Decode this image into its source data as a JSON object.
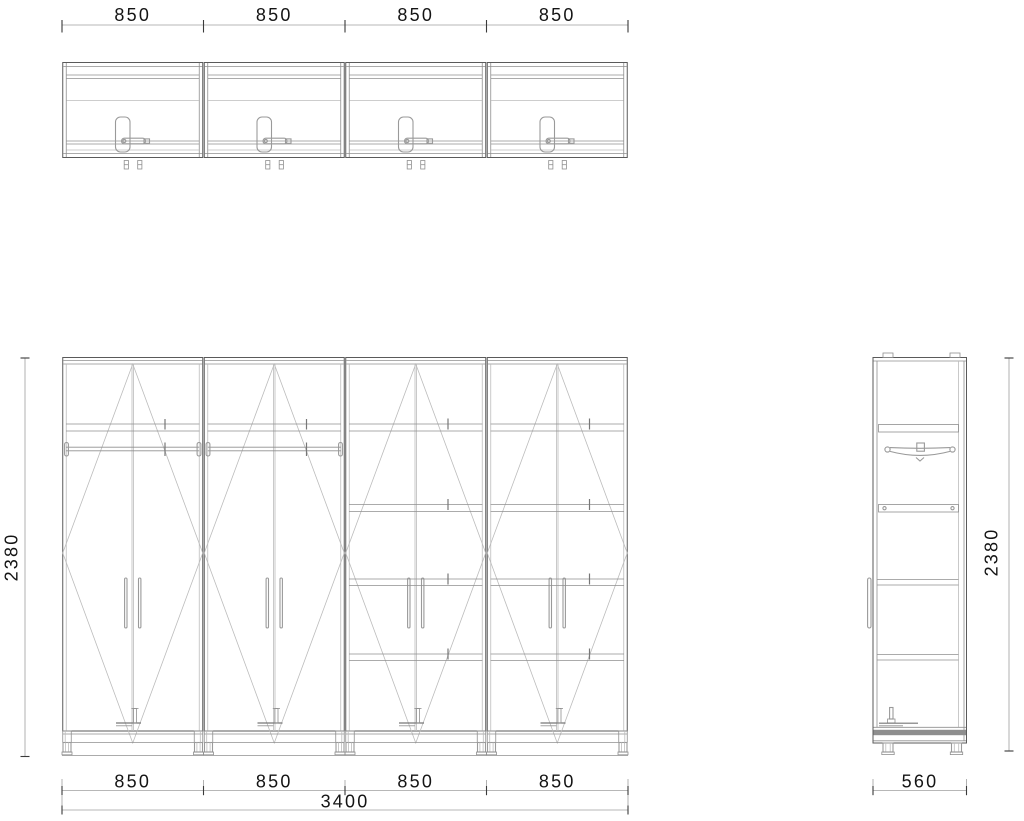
{
  "dimensions": {
    "plan_top": [
      "850",
      "850",
      "850",
      "850"
    ],
    "front_bottom": [
      "850",
      "850",
      "850",
      "850"
    ],
    "front_total_width": "3400",
    "front_height": "2380",
    "side_height": "2380",
    "side_depth": "560"
  }
}
